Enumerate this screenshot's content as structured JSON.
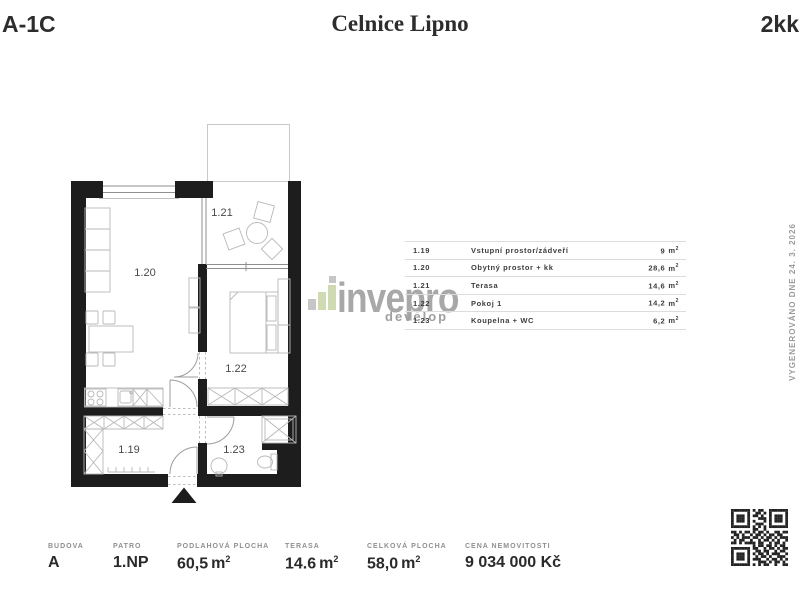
{
  "header": {
    "unit_code": "A-1C",
    "project_name": "Celnice Lipno",
    "layout_type": "2kk"
  },
  "floorplan": {
    "room_labels": {
      "r119": "1.19",
      "r120": "1.20",
      "r121": "1.21",
      "r122": "1.22",
      "r123": "1.23"
    }
  },
  "legend": {
    "unit_base": "m",
    "unit_sup": "2",
    "rows": [
      {
        "num": "1.19",
        "name": "Vstupní prostor/zádveří",
        "area": "9"
      },
      {
        "num": "1.20",
        "name": "Obytný prostor + kk",
        "area": "28,6"
      },
      {
        "num": "1.21",
        "name": "Terasa",
        "area": "14,6"
      },
      {
        "num": "1.22",
        "name": "Pokoj 1",
        "area": "14,2"
      },
      {
        "num": "1.23",
        "name": "Koupelna + WC",
        "area": "6,2"
      }
    ]
  },
  "watermark": {
    "name": "invepro",
    "tagline": "develop",
    "bar_gray": "#c6c6c6",
    "bar_green": "#cfdab2"
  },
  "generated_note": "VYGENEROVÁNO DNE 24. 3. 2026",
  "stats": {
    "unit_base": "m",
    "unit_sup": "2",
    "items": [
      {
        "label": "BUDOVA",
        "value": "A"
      },
      {
        "label": "PATRO",
        "value": "1.NP"
      },
      {
        "label": "PODLAHOVÁ PLOCHA",
        "value": "60,5"
      },
      {
        "label": "TERASA",
        "value": "14.6"
      },
      {
        "label": "CELKOVÁ PLOCHA",
        "value": "58,0"
      },
      {
        "label": "CENA NEMOVITOSTI",
        "value": "9 034 000 Kč"
      }
    ]
  },
  "qr": {
    "module_px": 2.7,
    "matrix": [
      "111111101011001111111",
      "100000100110101000001",
      "101110101101001011101",
      "101110100011101011101",
      "101110101000101011101",
      "100000100111001000001",
      "111111101010101111111",
      "000000001100100000000",
      "110101101011010011011",
      "011010010110101101100",
      "101011101101011010111",
      "010110010010110101001",
      "110101111011001011010",
      "000000001011011010110",
      "111111101100101101011",
      "100000100110110010110",
      "101110101011010111001",
      "101110100101101001110",
      "101110101110010110101",
      "100000100011101011010",
      "111111101010110010011"
    ]
  }
}
